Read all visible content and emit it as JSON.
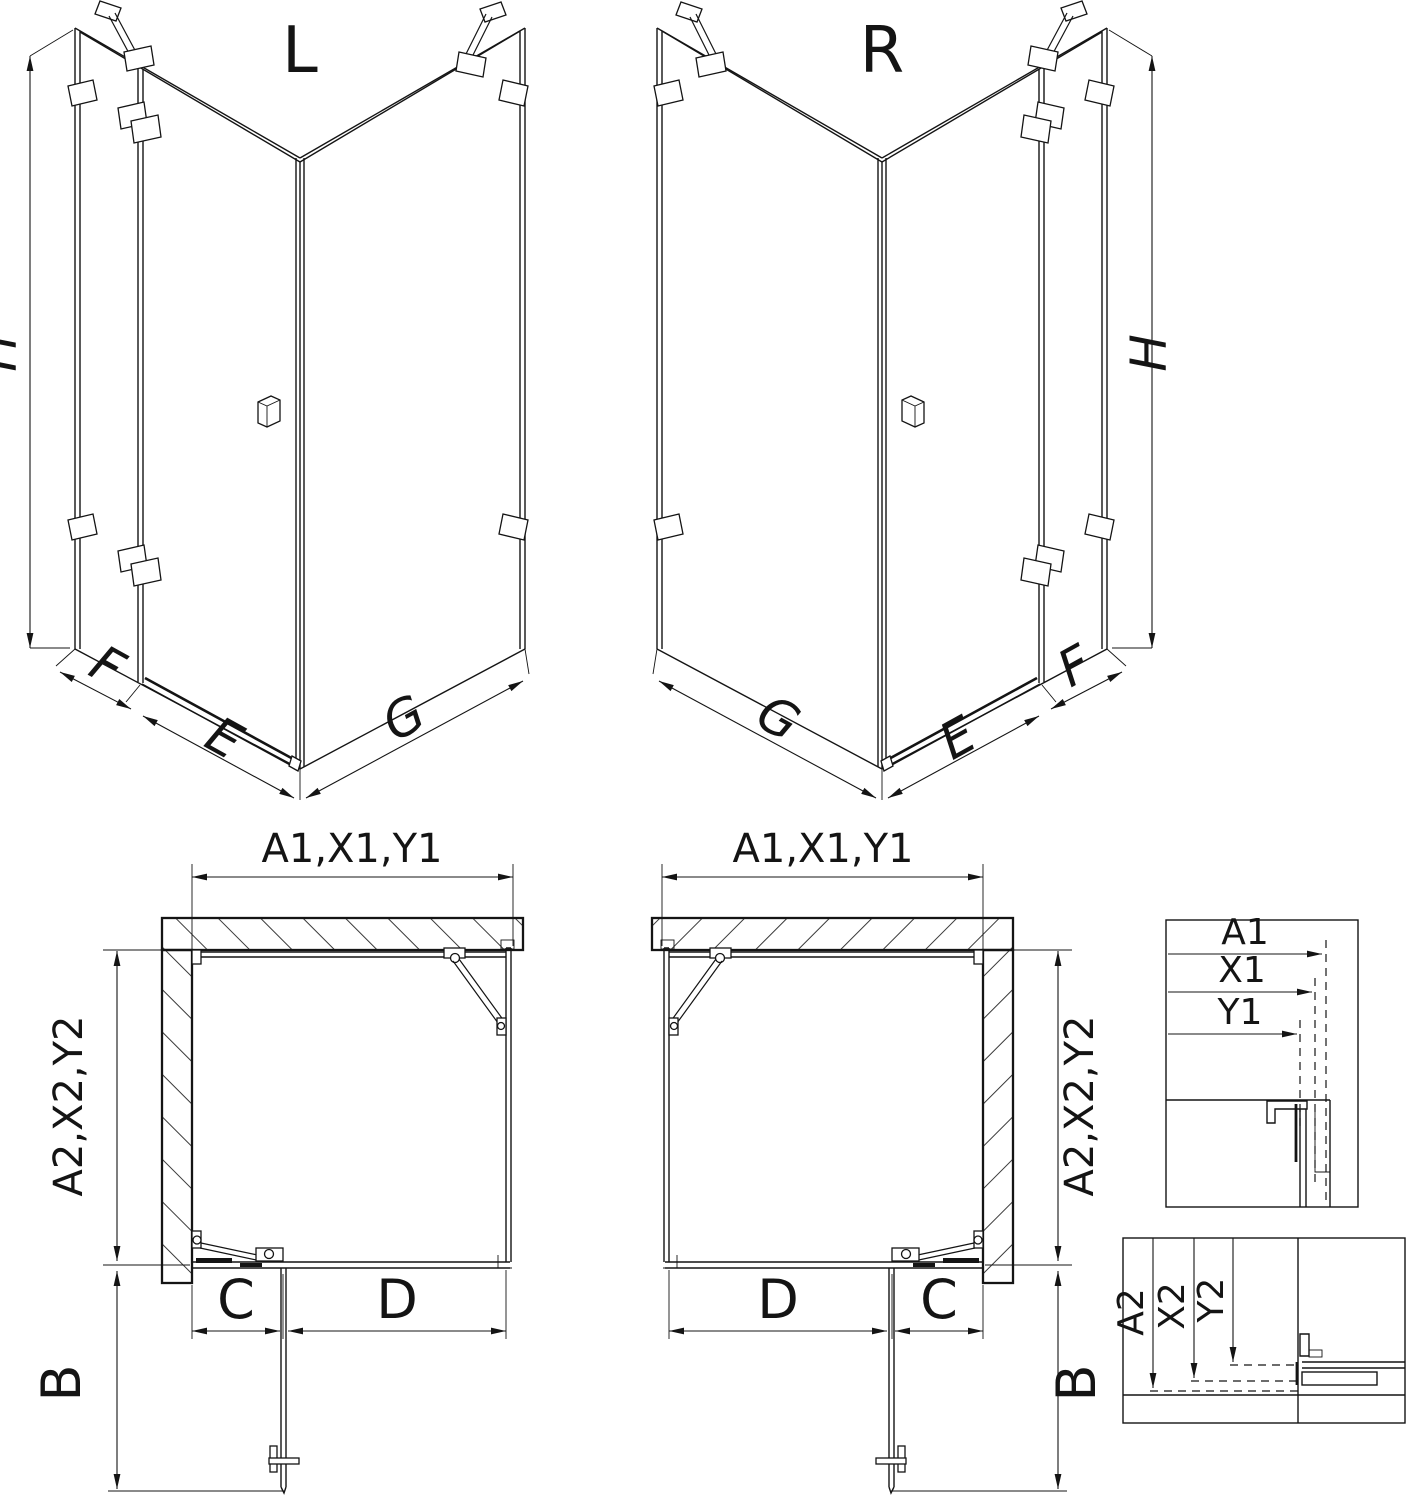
{
  "colors": {
    "line": "#141414",
    "background": "#ffffff"
  },
  "views": {
    "iso_left": {
      "title": "L",
      "dims": {
        "h": "H",
        "f": "F",
        "e": "E",
        "g": "G"
      }
    },
    "iso_right": {
      "title": "R",
      "dims": {
        "h": "H",
        "f": "F",
        "e": "E",
        "g": "G"
      }
    },
    "plan_left": {
      "dims": {
        "top": "A1,X1,Y1",
        "side": "A2,X2,Y2",
        "c": "C",
        "d": "D",
        "b": "B"
      }
    },
    "plan_right": {
      "dims": {
        "top": "A1,X1,Y1",
        "side": "A2,X2,Y2",
        "c": "C",
        "d": "D",
        "b": "B"
      }
    },
    "detail_horizontal": {
      "labels": {
        "a1": "A1",
        "x1": "X1",
        "y1": "Y1"
      }
    },
    "detail_vertical": {
      "labels": {
        "a2": "A2",
        "x2": "X2",
        "y2": "Y2"
      }
    }
  }
}
